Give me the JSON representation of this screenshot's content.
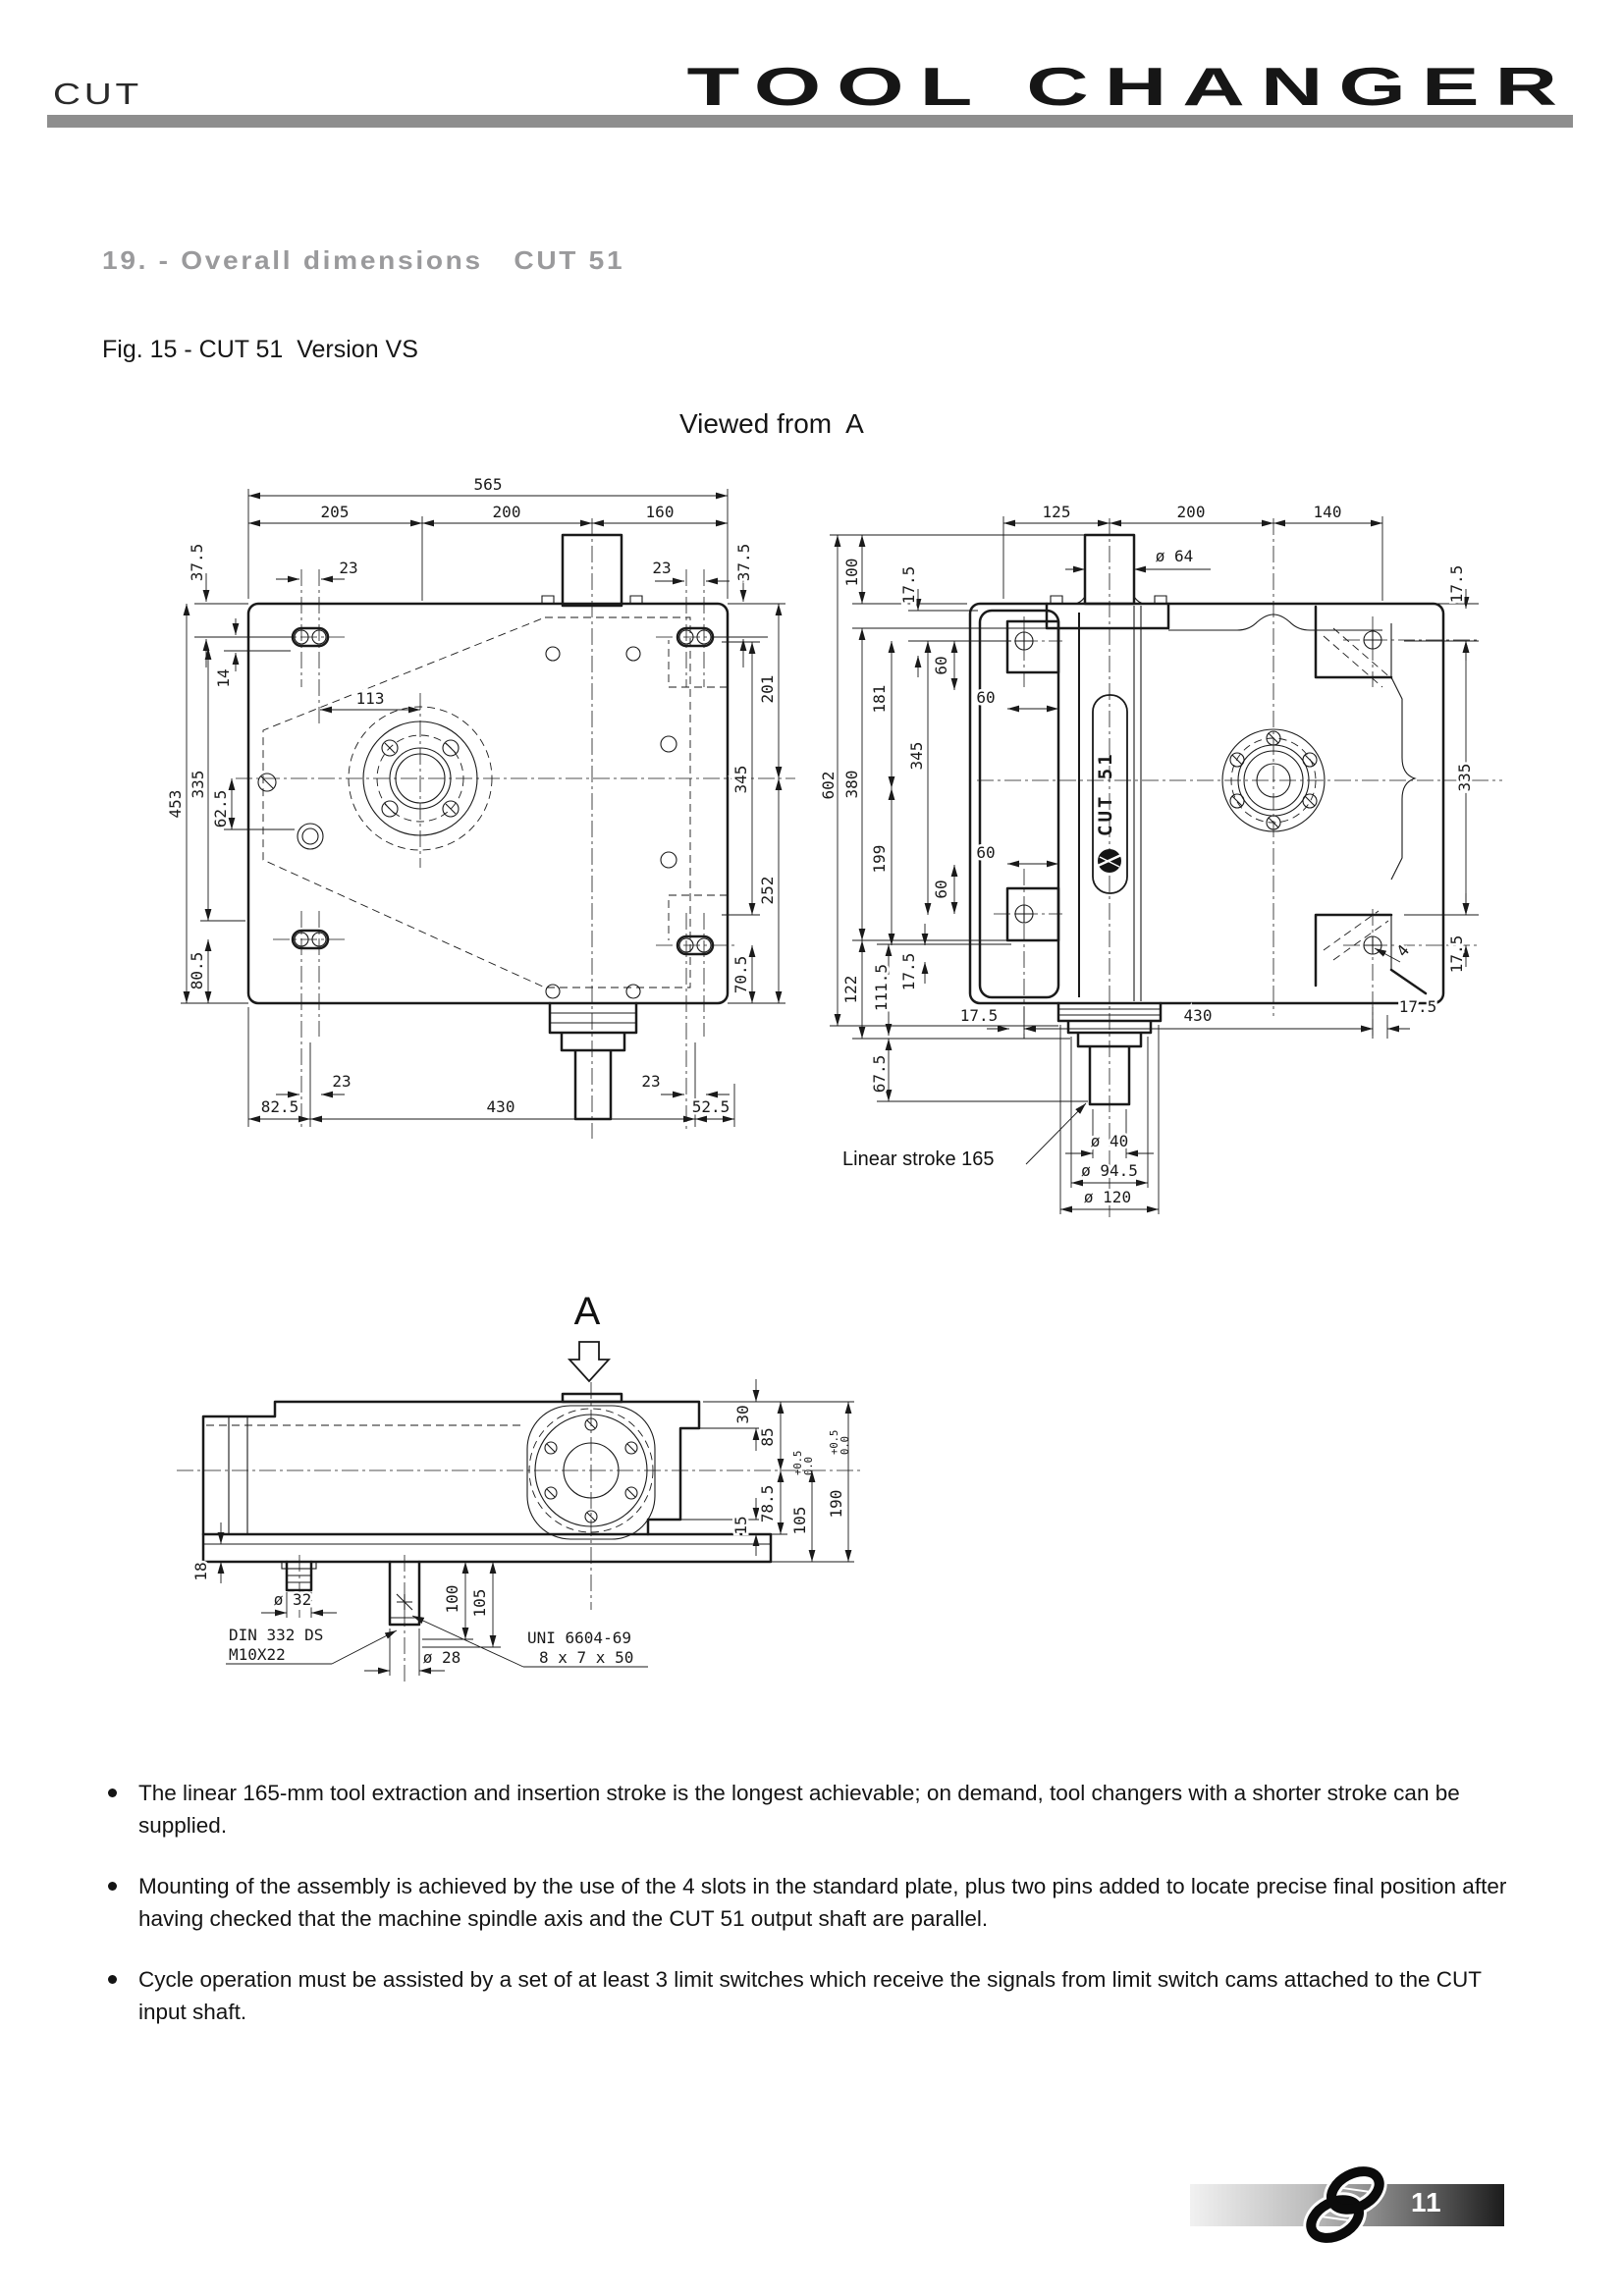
{
  "header": {
    "brand": "CUT",
    "title": "TOOL CHANGER"
  },
  "section": {
    "title": "19. - Overall dimensions   CUT 51"
  },
  "figure": {
    "caption": "Fig. 15 - CUT 51  Version VS",
    "viewed_from": "Viewed from  A"
  },
  "plan": {
    "d565": "565",
    "d205": "205",
    "d200": "200",
    "d160": "160",
    "d23_tl": "23",
    "d23_tr": "23",
    "d375_l": "37.5",
    "d375_r": "37.5",
    "d14": "14",
    "d113": "113",
    "d453": "453",
    "d335": "335",
    "d625": "62.5",
    "d805": "80.5",
    "d201": "201",
    "d345": "345",
    "d252": "252",
    "d705": "70.5",
    "d23_bl": "23",
    "d23_br": "23",
    "d825": "82.5",
    "d430": "430",
    "d525": "52.5"
  },
  "front": {
    "d125": "125",
    "d200": "200",
    "d140": "140",
    "dia64": "ø 64",
    "d100": "100",
    "d175_a": "17.5",
    "d181": "181",
    "d345": "345",
    "d199": "199",
    "d175_b": "17.5",
    "d602": "602",
    "d380": "380",
    "d122": "122",
    "d1115": "111.5",
    "d675": "67.5",
    "d60_a": "60",
    "d60_b": "60",
    "d60_c": "60",
    "d60_d": "60",
    "d175_c": "17.5",
    "d430": "430",
    "d175_d": "17.5",
    "d175_e": "17.5",
    "d335": "335",
    "d175_f": "17.5",
    "d4": "4",
    "stroke_note": "Linear stroke 165",
    "dia40": "ø 40",
    "dia945": "ø 94.5",
    "dia120": "ø 120",
    "nameplate": "CUT 51"
  },
  "side": {
    "view_label": "A",
    "d30": "30",
    "d85": "85",
    "d15": "15",
    "d785": "78.5",
    "d105": "105",
    "d190": "190",
    "tol_plus": "+0.5",
    "tol_zero": "0.0",
    "d18": "18",
    "dia32": "ø 32",
    "v100": "100",
    "v105": "105",
    "dia28": "ø 28",
    "din1": "DIN 332 DS",
    "din2": "M10X22",
    "uni1": "UNI 6604-69",
    "uni2": "8 x 7 x 50"
  },
  "bullets": {
    "b1": "The linear 165-mm tool extraction and insertion stroke is the longest achievable; on demand, tool changers with a shorter stroke can be supplied.",
    "b2": "Mounting of the assembly is achieved by the use of the 4 slots in the standard plate, plus two pins added to locate precise final position after having checked that the machine spindle axis and the CUT 51 output shaft are parallel.",
    "b3": "Cycle operation must be assisted by a set of at least 3 limit switches which receive the signals from limit switch cams attached to the CUT input shaft."
  },
  "footer": {
    "page": "11"
  }
}
